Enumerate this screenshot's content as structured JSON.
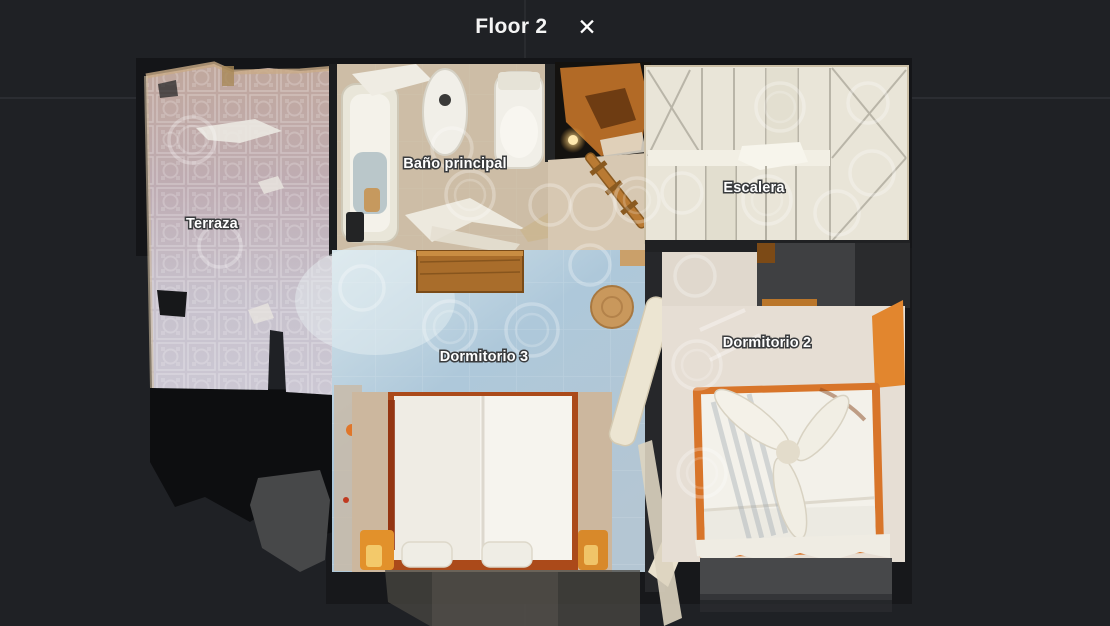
{
  "header": {
    "title": "Floor 2",
    "close_label": "✕"
  },
  "floorplan": {
    "rooms": [
      {
        "name": "terraza",
        "label": "Terraza"
      },
      {
        "name": "bano-principal",
        "label": "Baño principal"
      },
      {
        "name": "escalera",
        "label": "Escalera"
      },
      {
        "name": "dormitorio-3",
        "label": "Dormitorio 3"
      },
      {
        "name": "dormitorio-2",
        "label": "Dormitorio 2"
      }
    ]
  },
  "colors": {
    "background": "#1f2125",
    "wall_shadow": "#141518",
    "label_text": "#ffffff",
    "label_outline": "#3a3c3e",
    "terraza_tile": "#c4bac4",
    "bathroom_floor": "#cdbda6",
    "stairs_floor": "#e9e5d8",
    "dormitorio3_floor": "#aec8da",
    "dormitorio2_floor": "#e6ded4",
    "wood_furniture": "#a96d2b",
    "bed_frame_orange": "#d8752a",
    "scan_ring": "rgba(255,255,255,0.30)"
  }
}
